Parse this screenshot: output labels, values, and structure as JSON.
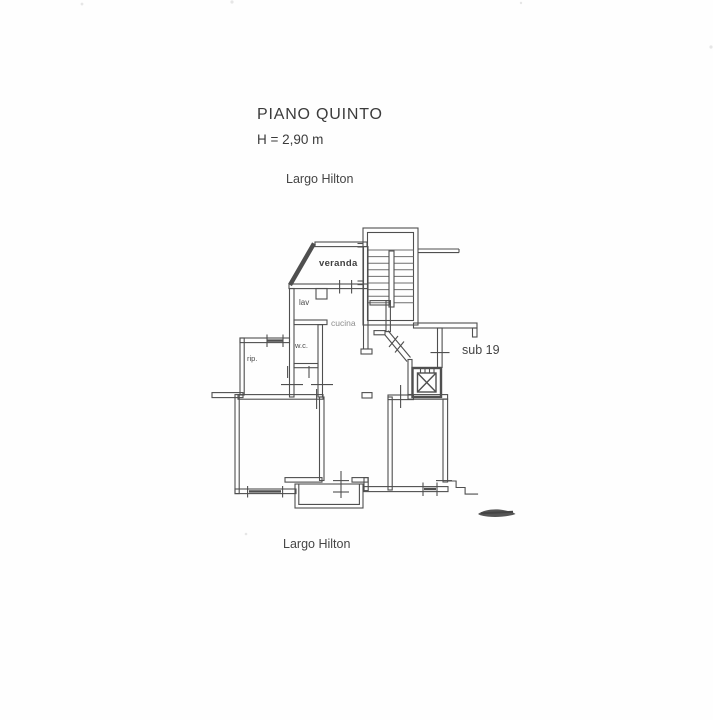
{
  "document": {
    "title": "PIANO QUINTO",
    "ceiling_height": "H = 2,90 m",
    "street_label_top": "Largo Hilton",
    "street_label_bottom": "Largo Hilton"
  },
  "plan": {
    "unit_label": "sub 19",
    "room_labels": {
      "veranda": "veranda",
      "laundry": "lav",
      "kitchen": "cucina",
      "wc": "w.c.",
      "storage": "rip."
    },
    "colors": {
      "wall_line": "#4f4f4f",
      "thin_line": "#6e6e6e",
      "faint_text": "#8d8d8d",
      "ink": "#3b3b3b",
      "smudge": "#555555"
    }
  }
}
